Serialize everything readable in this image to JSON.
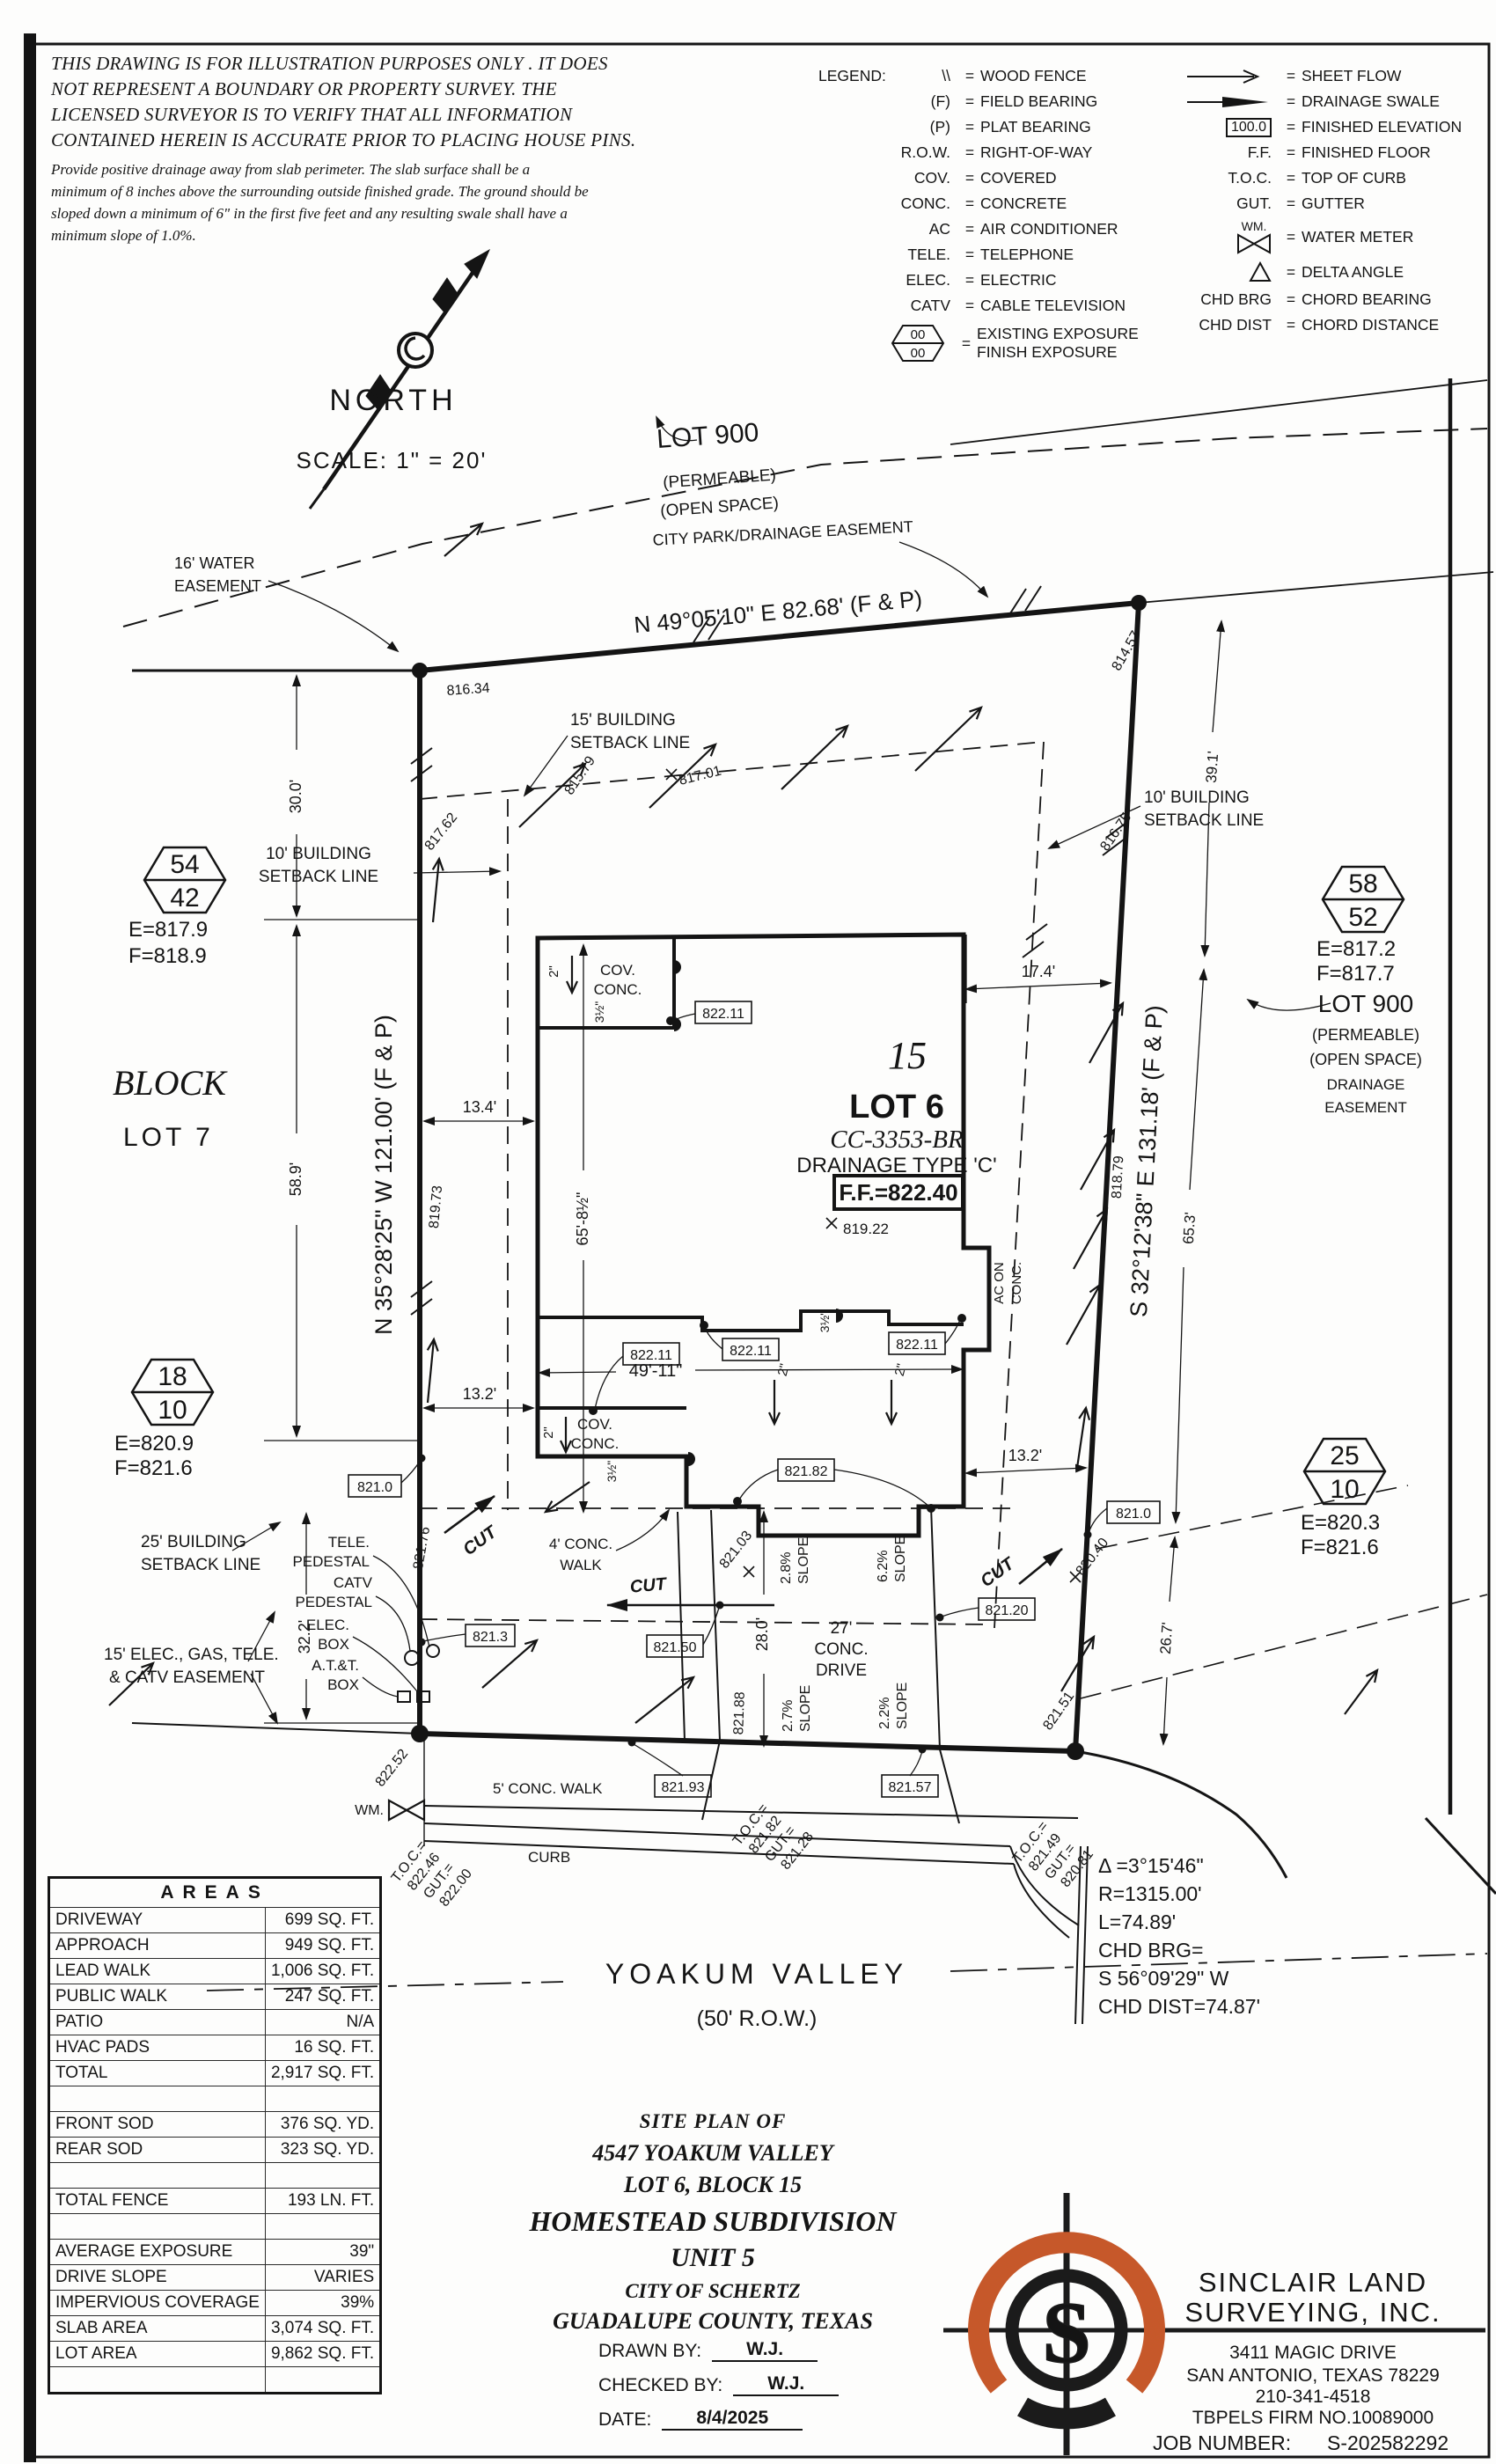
{
  "disclaimer": {
    "p1": [
      "THIS DRAWING IS FOR ILLUSTRATION PURPOSES ONLY . IT DOES",
      "NOT REPRESENT A BOUNDARY OR PROPERTY SURVEY. THE",
      "LICENSED SURVEYOR IS TO VERIFY THAT ALL INFORMATION",
      "CONTAINED HEREIN IS ACCURATE PRIOR TO PLACING HOUSE PINS."
    ],
    "p2": [
      "Provide positive drainage away from slab perimeter. The slab surface shall be a",
      "minimum of 8 inches above the surrounding outside finished grade. The ground should be",
      "sloped down a minimum of 6\" in the first five feet and any resulting swale shall have a",
      "minimum slope of 1.0%."
    ]
  },
  "north": {
    "label": "NORTH",
    "scale": "SCALE: 1\" = 20'"
  },
  "legend": {
    "title": "LEGEND:",
    "eq": "=",
    "left": [
      {
        "sym": "\\\\",
        "desc": "WOOD FENCE"
      },
      {
        "sym": "(F)",
        "desc": "FIELD BEARING"
      },
      {
        "sym": "(P)",
        "desc": "PLAT BEARING"
      },
      {
        "sym": "R.O.W.",
        "desc": "RIGHT-OF-WAY"
      },
      {
        "sym": "COV.",
        "desc": "COVERED"
      },
      {
        "sym": "CONC.",
        "desc": "CONCRETE"
      },
      {
        "sym": "AC",
        "desc": "AIR CONDITIONER"
      },
      {
        "sym": "TELE.",
        "desc": "TELEPHONE"
      },
      {
        "sym": "ELEC.",
        "desc": "ELECTRIC"
      },
      {
        "sym": "CATV",
        "desc": "CABLE TELEVISION"
      }
    ],
    "exposure": {
      "top": "00",
      "bottom": "00",
      "desc1": "EXISTING EXPOSURE",
      "desc2": "FINISH EXPOSURE"
    },
    "right": [
      {
        "sym": "",
        "desc": "SHEET FLOW"
      },
      {
        "sym": "",
        "desc": "DRAINAGE SWALE"
      },
      {
        "sym": "100.0",
        "desc": "FINISHED ELEVATION"
      },
      {
        "sym": "F.F.",
        "desc": "FINISHED FLOOR"
      },
      {
        "sym": "T.O.C.",
        "desc": "TOP OF CURB"
      },
      {
        "sym": "GUT.",
        "desc": "GUTTER"
      },
      {
        "sym": "WM.",
        "desc": "WATER METER"
      },
      {
        "sym": "",
        "desc": "DELTA ANGLE"
      },
      {
        "sym": "CHD BRG",
        "desc": "CHORD BEARING"
      },
      {
        "sym": "CHD DIST",
        "desc": "CHORD DISTANCE"
      }
    ]
  },
  "plan": {
    "lot900_top": {
      "name": "LOT 900",
      "permeable": "(PERMEABLE)",
      "open_space": "(OPEN SPACE)",
      "city_park": "CITY PARK/DRAINAGE EASEMENT"
    },
    "lot900_right": {
      "name": "LOT 900",
      "permeable": "(PERMEABLE)",
      "open_space": "(OPEN SPACE)",
      "drainage": "DRAINAGE",
      "easement": "EASEMENT"
    },
    "bearings": {
      "top": "N 49°05'10\" E  82.68'  (F & P)",
      "left": "N 35°28'25\" W 121.00' (F & P)",
      "right": "S 32°12'38\" E  131.18'  (F & P)"
    },
    "setbacks": {
      "b15a": "15' BUILDING",
      "b15b": "SETBACK LINE",
      "b10a": "10' BUILDING",
      "b10b": "SETBACK LINE",
      "b25a": "25' BUILDING",
      "b25b": "SETBACK LINE",
      "easea": "15' ELEC., GAS, TELE.",
      "easeb": "& CATV EASEMENT",
      "watera": "16' WATER",
      "waterb": "EASEMENT"
    },
    "adjacent": {
      "block": "BLOCK",
      "lot7": "LOT 7"
    },
    "hex54": {
      "top": "54",
      "bot": "42",
      "e": "E=817.9",
      "f": "F=818.9"
    },
    "hex58": {
      "top": "58",
      "bot": "52",
      "e": "E=817.2",
      "f": "F=817.7"
    },
    "hex18": {
      "top": "18",
      "bot": "10",
      "e": "E=820.9",
      "f": "F=821.6"
    },
    "hex25": {
      "top": "25",
      "bot": "10",
      "e": "E=820.3",
      "f": "F=821.6"
    },
    "house": {
      "block_num": "15",
      "lot": "LOT 6",
      "plan_code": "CC-3353-BR",
      "drainage": "DRAINAGE TYPE 'C'",
      "ff": "F.F.=822.40",
      "spot": "819.22",
      "cov": "COV.",
      "conc": "CONC.",
      "ac1": "AC ON",
      "ac2": "CONC."
    },
    "dims": {
      "d30": "30.0'",
      "d589": "58.9'",
      "d134": "13.4'",
      "d132": "13.2'",
      "d174": "17.4'",
      "d4911": "49'-11\"",
      "d658": "65'-8½\"",
      "d322": "32.2'",
      "d280": "28.0'",
      "d391": "39.1'",
      "d653": "65.3'",
      "d267": "26.7'",
      "d2": "2\"",
      "d35": "3½\""
    },
    "slopes": {
      "s28": "2.8%",
      "s62": "6.2%",
      "s27": "2.7%",
      "s22": "2.2%",
      "word": "SLOPE"
    },
    "drive": {
      "l1": "27'",
      "l2": "CONC.",
      "l3": "DRIVE"
    },
    "walks": {
      "w4a": "4' CONC.",
      "w4b": "WALK",
      "w5": "5' CONC. WALK"
    },
    "cut": "CUT",
    "spots": {
      "s81634": "816.34",
      "s81579": "815.79",
      "s81457": "814.57",
      "s81762": "817.62",
      "s81701": "817.01",
      "s81675": "816.75",
      "s81973": "819.73",
      "s81879": "818.79",
      "s82176": "821.76",
      "s82040": "820.40",
      "s82151": "821.51",
      "s82188": "821.88",
      "s82103": "821.03",
      "s82252": "822.52"
    },
    "boxes": {
      "fe": "822.11",
      "e82182": "821.82",
      "e8210": "821.0",
      "e82120": "821.20",
      "e8213": "821.3",
      "e82150": "821.50",
      "e82193": "821.93",
      "e82157": "821.57"
    },
    "utils": {
      "tele1": "TELE.",
      "tele2": "PEDESTAL",
      "catv1": "CATV",
      "catv2": "PEDESTAL",
      "elec1": "ELEC.",
      "elec2": "BOX",
      "att1": "A.T.&T.",
      "att2": "BOX"
    },
    "toc": {
      "toc": "T.O.C.=",
      "gut": "GUT.=",
      "v1t": "822.46",
      "v1g": "822.00",
      "v2t": "821.82",
      "v2g": "821.28",
      "v3t": "821.49",
      "v3g": "820.81"
    },
    "street": {
      "name": "YOAKUM VALLEY",
      "row": "(50' R.O.W.)",
      "curb": "CURB",
      "wm": "WM."
    },
    "curve": {
      "delta": "Δ =3°15'46\"",
      "r": "R=1315.00'",
      "l": "L=74.89'",
      "cb1": "CHD BRG=",
      "cb2": "S 56°09'29\" W",
      "cd": "CHD DIST=74.87'"
    }
  },
  "areas": {
    "title": "AREAS",
    "rows": [
      {
        "label": "DRIVEWAY",
        "value": "699 SQ. FT."
      },
      {
        "label": "APPROACH",
        "value": "949 SQ. FT."
      },
      {
        "label": "LEAD WALK",
        "value": "1,006 SQ. FT."
      },
      {
        "label": "PUBLIC WALK",
        "value": "247 SQ. FT."
      },
      {
        "label": "PATIO",
        "value": "N/A"
      },
      {
        "label": "HVAC PADS",
        "value": "16 SQ. FT."
      },
      {
        "label": "TOTAL",
        "value": "2,917 SQ. FT."
      },
      {
        "label": "",
        "value": ""
      },
      {
        "label": "FRONT SOD",
        "value": "376 SQ. YD."
      },
      {
        "label": "REAR SOD",
        "value": "323 SQ. YD."
      },
      {
        "label": "",
        "value": ""
      },
      {
        "label": "TOTAL FENCE",
        "value": "193 LN. FT."
      },
      {
        "label": "",
        "value": ""
      },
      {
        "label": "AVERAGE EXPOSURE",
        "value": "39\""
      },
      {
        "label": "DRIVE SLOPE",
        "value": "VARIES"
      },
      {
        "label": "IMPERVIOUS COVERAGE",
        "value": "39%"
      },
      {
        "label": "SLAB AREA",
        "value": "3,074 SQ. FT."
      },
      {
        "label": "LOT AREA",
        "value": "9,862 SQ. FT."
      },
      {
        "label": "",
        "value": ""
      }
    ]
  },
  "title_block": {
    "l1": "SITE PLAN OF",
    "l2": "4547 YOAKUM VALLEY",
    "l3": "LOT 6, BLOCK 15",
    "l4": "HOMESTEAD SUBDIVISION",
    "l5": "UNIT 5",
    "l6": "CITY OF SCHERTZ",
    "l7": "GUADALUPE COUNTY, TEXAS",
    "drawn_label": "DRAWN BY:",
    "drawn": "W.J.",
    "checked_label": "CHECKED BY:",
    "checked": "W.J.",
    "date_label": "DATE:",
    "date": "8/4/2025"
  },
  "firm": {
    "name1": "SINCLAIR LAND",
    "name2": "SURVEYING, INC.",
    "addr1": "3411 MAGIC DRIVE",
    "addr2": "SAN ANTONIO, TEXAS 78229",
    "phone": "210-341-4518",
    "firm_no": "TBPELS FIRM NO.10089000",
    "job_label": "JOB NUMBER:",
    "job": "S-202582292",
    "logo_letter": "S",
    "accent": "#c6582a"
  }
}
